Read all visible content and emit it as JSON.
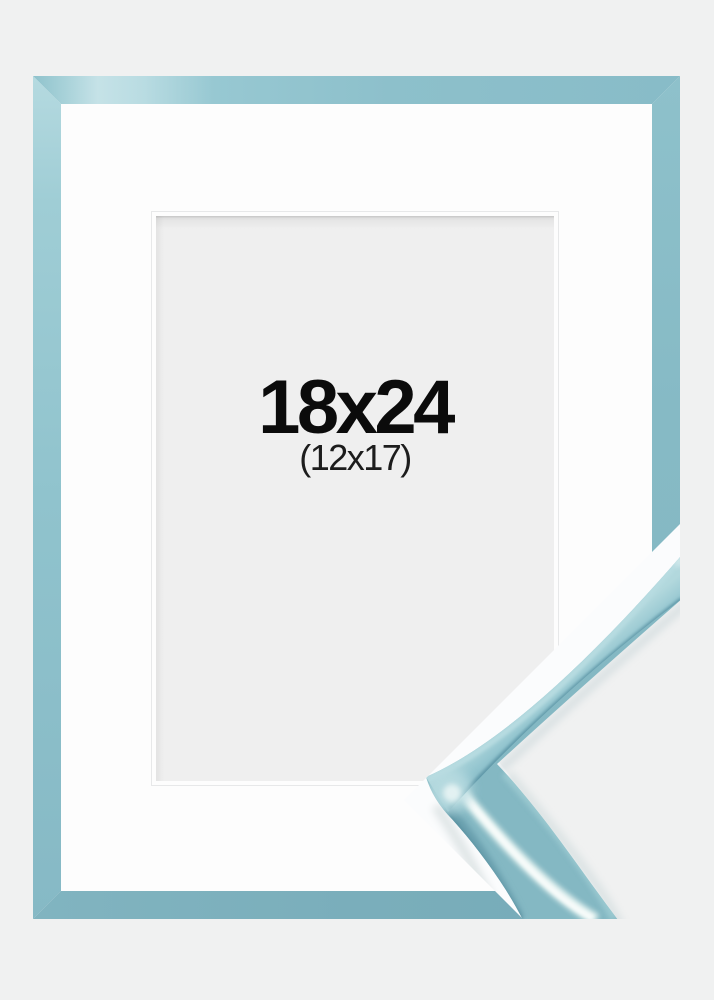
{
  "image": {
    "size_label": "18x24",
    "inner_size_label": "(12x17)"
  },
  "colors": {
    "background": "#f0f1f1",
    "frame_base": "#87bcc7",
    "frame_highlight": "#c5e2e7",
    "frame_shadow": "#74a9b6",
    "mat": "#fdfdfd",
    "artwork_area": "#efefef",
    "size_text": "#0b0b0b",
    "inner_size_text": "#1c1c1c",
    "detail_backdrop": "#fbfcfd",
    "molding_dark": "#5e96a4",
    "molding_gloss": "#ecf7f4"
  }
}
